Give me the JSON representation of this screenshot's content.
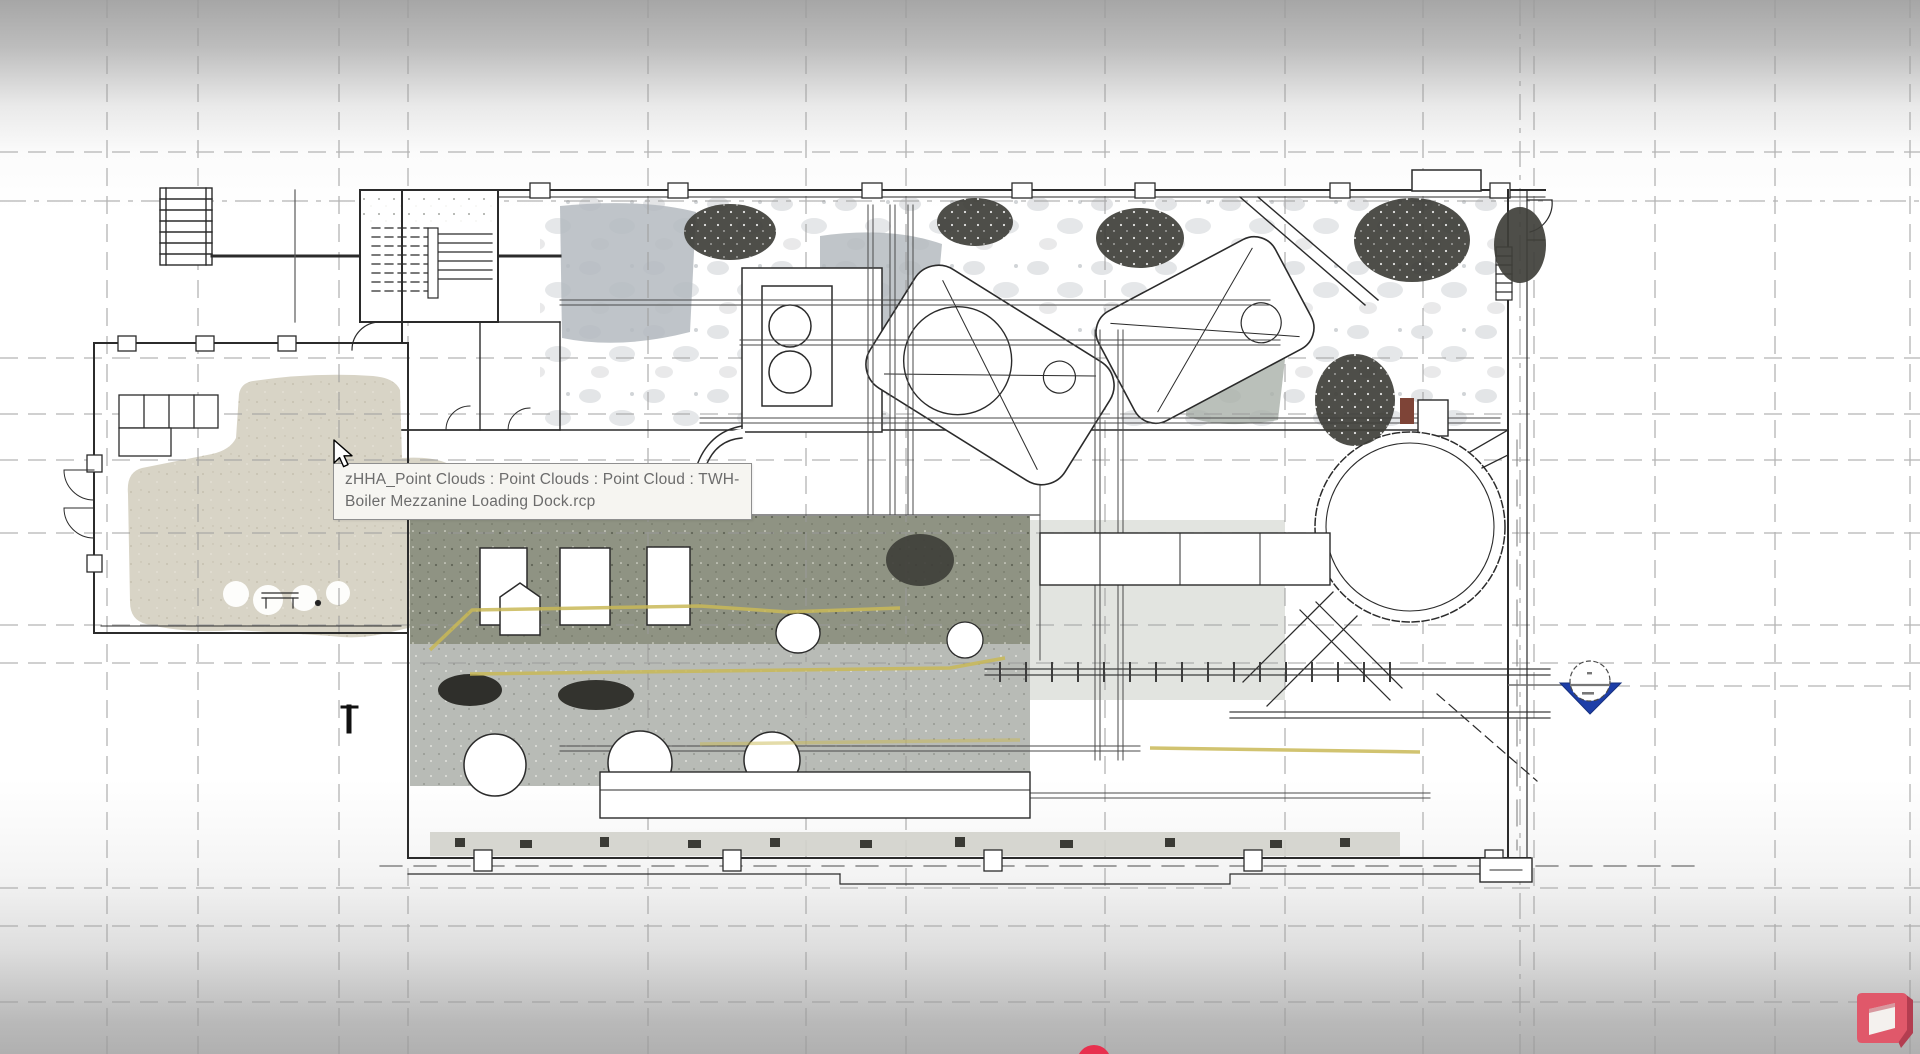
{
  "tooltip": {
    "line1": "zHHA_Point Clouds : Point Clouds : Point Cloud : TWH-",
    "line2": "Boiler Mezzanine Loading Dock.rcp"
  },
  "icons": {
    "cursor": "cursor-icon",
    "section_head": "section-head-icon",
    "watermark": "watermark-logo-icon",
    "record_dot": "record-dot-icon"
  },
  "colors": {
    "point_cloud_beige": "#d8d4c6",
    "point_cloud_olive": "#8f9383",
    "point_cloud_concrete": "#b8bbb6",
    "point_cloud_dark": "#3f3f3a",
    "wall_ink": "#2b2b2b",
    "grid_gray": "#9b9b9b",
    "floor_marking_yellow": "#c9b957",
    "section_blue": "#1d3ea8",
    "watermark_red": "#e0586a",
    "record_red": "#e8304e",
    "tooltip_bg": "#f6f5f1",
    "tooltip_text": "#6c6c6c"
  }
}
